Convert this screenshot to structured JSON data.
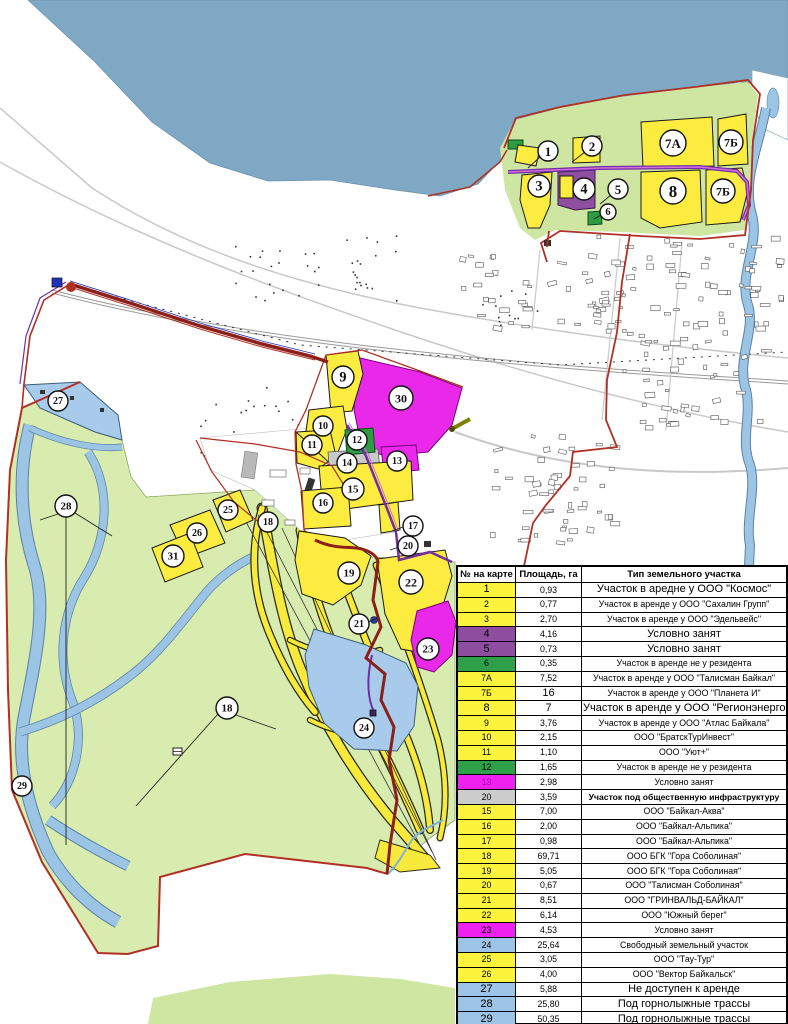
{
  "map": {
    "colors": {
      "water": "#7fa8c5",
      "river": "#9cc4e4",
      "vegetation_light_green": "#d7ecae",
      "cluster_light_green": "#cfe6a2",
      "plot_yellow": "#fcec3f",
      "plot_magenta": "#e928e9",
      "plot_purple": "#8f4fa0",
      "plot_green": "#2f9c44",
      "plot_gray": "#c9c9c9",
      "plot_blue": "#a8cbec",
      "boundary_red": "#b03024",
      "road_dark_red": "#8b2018",
      "line_violet": "#7030a0"
    },
    "labels": [
      {
        "t": "1",
        "x": 548,
        "y": 151,
        "r": 10
      },
      {
        "t": "2",
        "x": 592,
        "y": 146,
        "r": 10
      },
      {
        "t": "3",
        "x": 539,
        "y": 186,
        "r": 11
      },
      {
        "t": "4",
        "x": 584,
        "y": 189,
        "r": 11
      },
      {
        "t": "5",
        "x": 618,
        "y": 189,
        "r": 10
      },
      {
        "t": "6",
        "x": 608,
        "y": 212,
        "r": 8
      },
      {
        "t": "7А",
        "x": 673,
        "y": 143,
        "r": 13
      },
      {
        "t": "7Б",
        "x": 731,
        "y": 142,
        "r": 12
      },
      {
        "t": "8",
        "x": 673,
        "y": 191,
        "r": 13
      },
      {
        "t": "7Б",
        "x": 723,
        "y": 191,
        "r": 12
      },
      {
        "t": "9",
        "x": 343,
        "y": 377,
        "r": 11
      },
      {
        "t": "30",
        "x": 401,
        "y": 398,
        "r": 12
      },
      {
        "t": "10",
        "x": 323,
        "y": 426,
        "r": 10
      },
      {
        "t": "11",
        "x": 312,
        "y": 445,
        "r": 10
      },
      {
        "t": "12",
        "x": 357,
        "y": 440,
        "r": 10
      },
      {
        "t": "13",
        "x": 397,
        "y": 461,
        "r": 10
      },
      {
        "t": "14",
        "x": 347,
        "y": 463,
        "r": 10
      },
      {
        "t": "15",
        "x": 353,
        "y": 489,
        "r": 11
      },
      {
        "t": "16",
        "x": 323,
        "y": 503,
        "r": 10
      },
      {
        "t": "17",
        "x": 413,
        "y": 526,
        "r": 10
      },
      {
        "t": "20",
        "x": 408,
        "y": 546,
        "r": 10
      },
      {
        "t": "19",
        "x": 349,
        "y": 573,
        "r": 11
      },
      {
        "t": "22",
        "x": 411,
        "y": 582,
        "r": 12
      },
      {
        "t": "21",
        "x": 359,
        "y": 624,
        "r": 10
      },
      {
        "t": "23",
        "x": 428,
        "y": 649,
        "r": 11
      },
      {
        "t": "24",
        "x": 364,
        "y": 728,
        "r": 10
      },
      {
        "t": "25",
        "x": 228,
        "y": 510,
        "r": 10
      },
      {
        "t": "26",
        "x": 197,
        "y": 533,
        "r": 10
      },
      {
        "t": "31",
        "x": 173,
        "y": 556,
        "r": 11
      },
      {
        "t": "18",
        "x": 268,
        "y": 522,
        "r": 10
      },
      {
        "t": "18",
        "x": 227,
        "y": 708,
        "r": 11
      },
      {
        "t": "27",
        "x": 58,
        "y": 401,
        "r": 10
      },
      {
        "t": "28",
        "x": 66,
        "y": 506,
        "r": 11
      },
      {
        "t": "29",
        "x": 22,
        "y": 786,
        "r": 10
      }
    ]
  },
  "table": {
    "headers": [
      "№ на карте",
      "Площадь, га",
      "Тип земельного участка"
    ],
    "colors": {
      "yellow": "#fcf43c",
      "purple": "#8e4d9e",
      "green": "#2fa04a",
      "magenta": "#ee22ee",
      "gray": "#cccccc",
      "blue": "#9dc3e6"
    },
    "rows": [
      {
        "n": "1",
        "a": "0,93",
        "t": "Участок в аредне у ООО \"Космос\"",
        "c": "yellow",
        "tb": true
      },
      {
        "n": "2",
        "a": "0,77",
        "t": "Участок в аренде у ООО \"Сахалин Групп\"",
        "c": "yellow"
      },
      {
        "n": "3",
        "a": "2,70",
        "t": "Участок в аренде у ООО \"Эдельвейс\"",
        "c": "yellow"
      },
      {
        "n": "4",
        "a": "4,16",
        "t": "Условно занят",
        "c": "purple",
        "tb": true
      },
      {
        "n": "5",
        "a": "0,73",
        "t": "Условно занят",
        "c": "purple",
        "tb": true
      },
      {
        "n": "6",
        "a": "0,35",
        "t": "Участок в аренде не у резидента",
        "c": "green"
      },
      {
        "n": "7А",
        "a": "7,52",
        "t": "Участок в аренде у ООО \"Талисман Байкал\"",
        "c": "yellow"
      },
      {
        "n": "7Б",
        "a": "16",
        "t": "Участок в аренде у ООО \"Планета И\"",
        "c": "yellow",
        "ab": true
      },
      {
        "n": "8",
        "a": "7",
        "t": "Участок в аренде у ООО \"Регионэнерго\"",
        "c": "yellow",
        "tb": true,
        "ab": true
      },
      {
        "n": "9",
        "a": "3,76",
        "t": "Участок в аренде у ООО \"Атлас Байкала\"",
        "c": "yellow"
      },
      {
        "n": "10",
        "a": "2,15",
        "t": "ООО \"БратскТурИнвест\"",
        "c": "yellow"
      },
      {
        "n": "11",
        "a": "1,10",
        "t": "ООО \"Уют+\"",
        "c": "yellow"
      },
      {
        "n": "12",
        "a": "1,65",
        "t": "Участок в аренде не у резидента",
        "c": "green"
      },
      {
        "n": "13",
        "a": "2,98",
        "t": "Условно занят",
        "c": "magenta",
        "nc": "#b000b0"
      },
      {
        "n": "20",
        "a": "3,59",
        "t": "Участок под общественную инфраструктуру",
        "c": "gray",
        "bold": true
      },
      {
        "n": "15",
        "a": "7,00",
        "t": "ООО \"Байкал-Аква\"",
        "c": "yellow"
      },
      {
        "n": "16",
        "a": "2,00",
        "t": "ООО \"Байкал-Альпика\"",
        "c": "yellow"
      },
      {
        "n": "17",
        "a": "0,98",
        "t": "ООО \"Байкал-Альпика\"",
        "c": "yellow"
      },
      {
        "n": "18",
        "a": "69,71",
        "t": "ООО БГК \"Гора Соболиная\"",
        "c": "yellow"
      },
      {
        "n": "19",
        "a": "5,05",
        "t": "ООО БГК \"Гора Соболиная\"",
        "c": "yellow"
      },
      {
        "n": "20",
        "a": "0,67",
        "t": "ООО \"Талисман Соболиная\"",
        "c": "yellow"
      },
      {
        "n": "21",
        "a": "8,51",
        "t": "ООО \"ГРИНВАЛЬД-БАЙКАЛ\"",
        "c": "yellow"
      },
      {
        "n": "22",
        "a": "6,14",
        "t": "ООО \"Южный берег\"",
        "c": "yellow"
      },
      {
        "n": "23",
        "a": "4,53",
        "t": "Условно занят",
        "c": "magenta"
      },
      {
        "n": "24",
        "a": "25,64",
        "t": "Свободный земельный участок",
        "c": "blue"
      },
      {
        "n": "25",
        "a": "3,05",
        "t": "ООО \"Тау-Тур\"",
        "c": "yellow"
      },
      {
        "n": "26",
        "a": "4,00",
        "t": "ООО \"Вектор Байкальск\"",
        "c": "yellow"
      },
      {
        "n": "27",
        "a": "5,88",
        "t": "Не доступен к аренде",
        "c": "blue",
        "tb": true
      },
      {
        "n": "28",
        "a": "25,80",
        "t": "Под горнолыжные трассы",
        "c": "blue",
        "tb": true
      },
      {
        "n": "29",
        "a": "50,35",
        "t": "Под горнолыжные трассы",
        "c": "blue",
        "tb": true
      },
      {
        "n": "30",
        "a": "19,73",
        "t": "Условно занят",
        "c": "magenta",
        "nc": "#b000b0"
      },
      {
        "n": "31",
        "a": "4,00",
        "t": "ООО \"Байкальская гора\"",
        "c": "yellow"
      }
    ]
  }
}
